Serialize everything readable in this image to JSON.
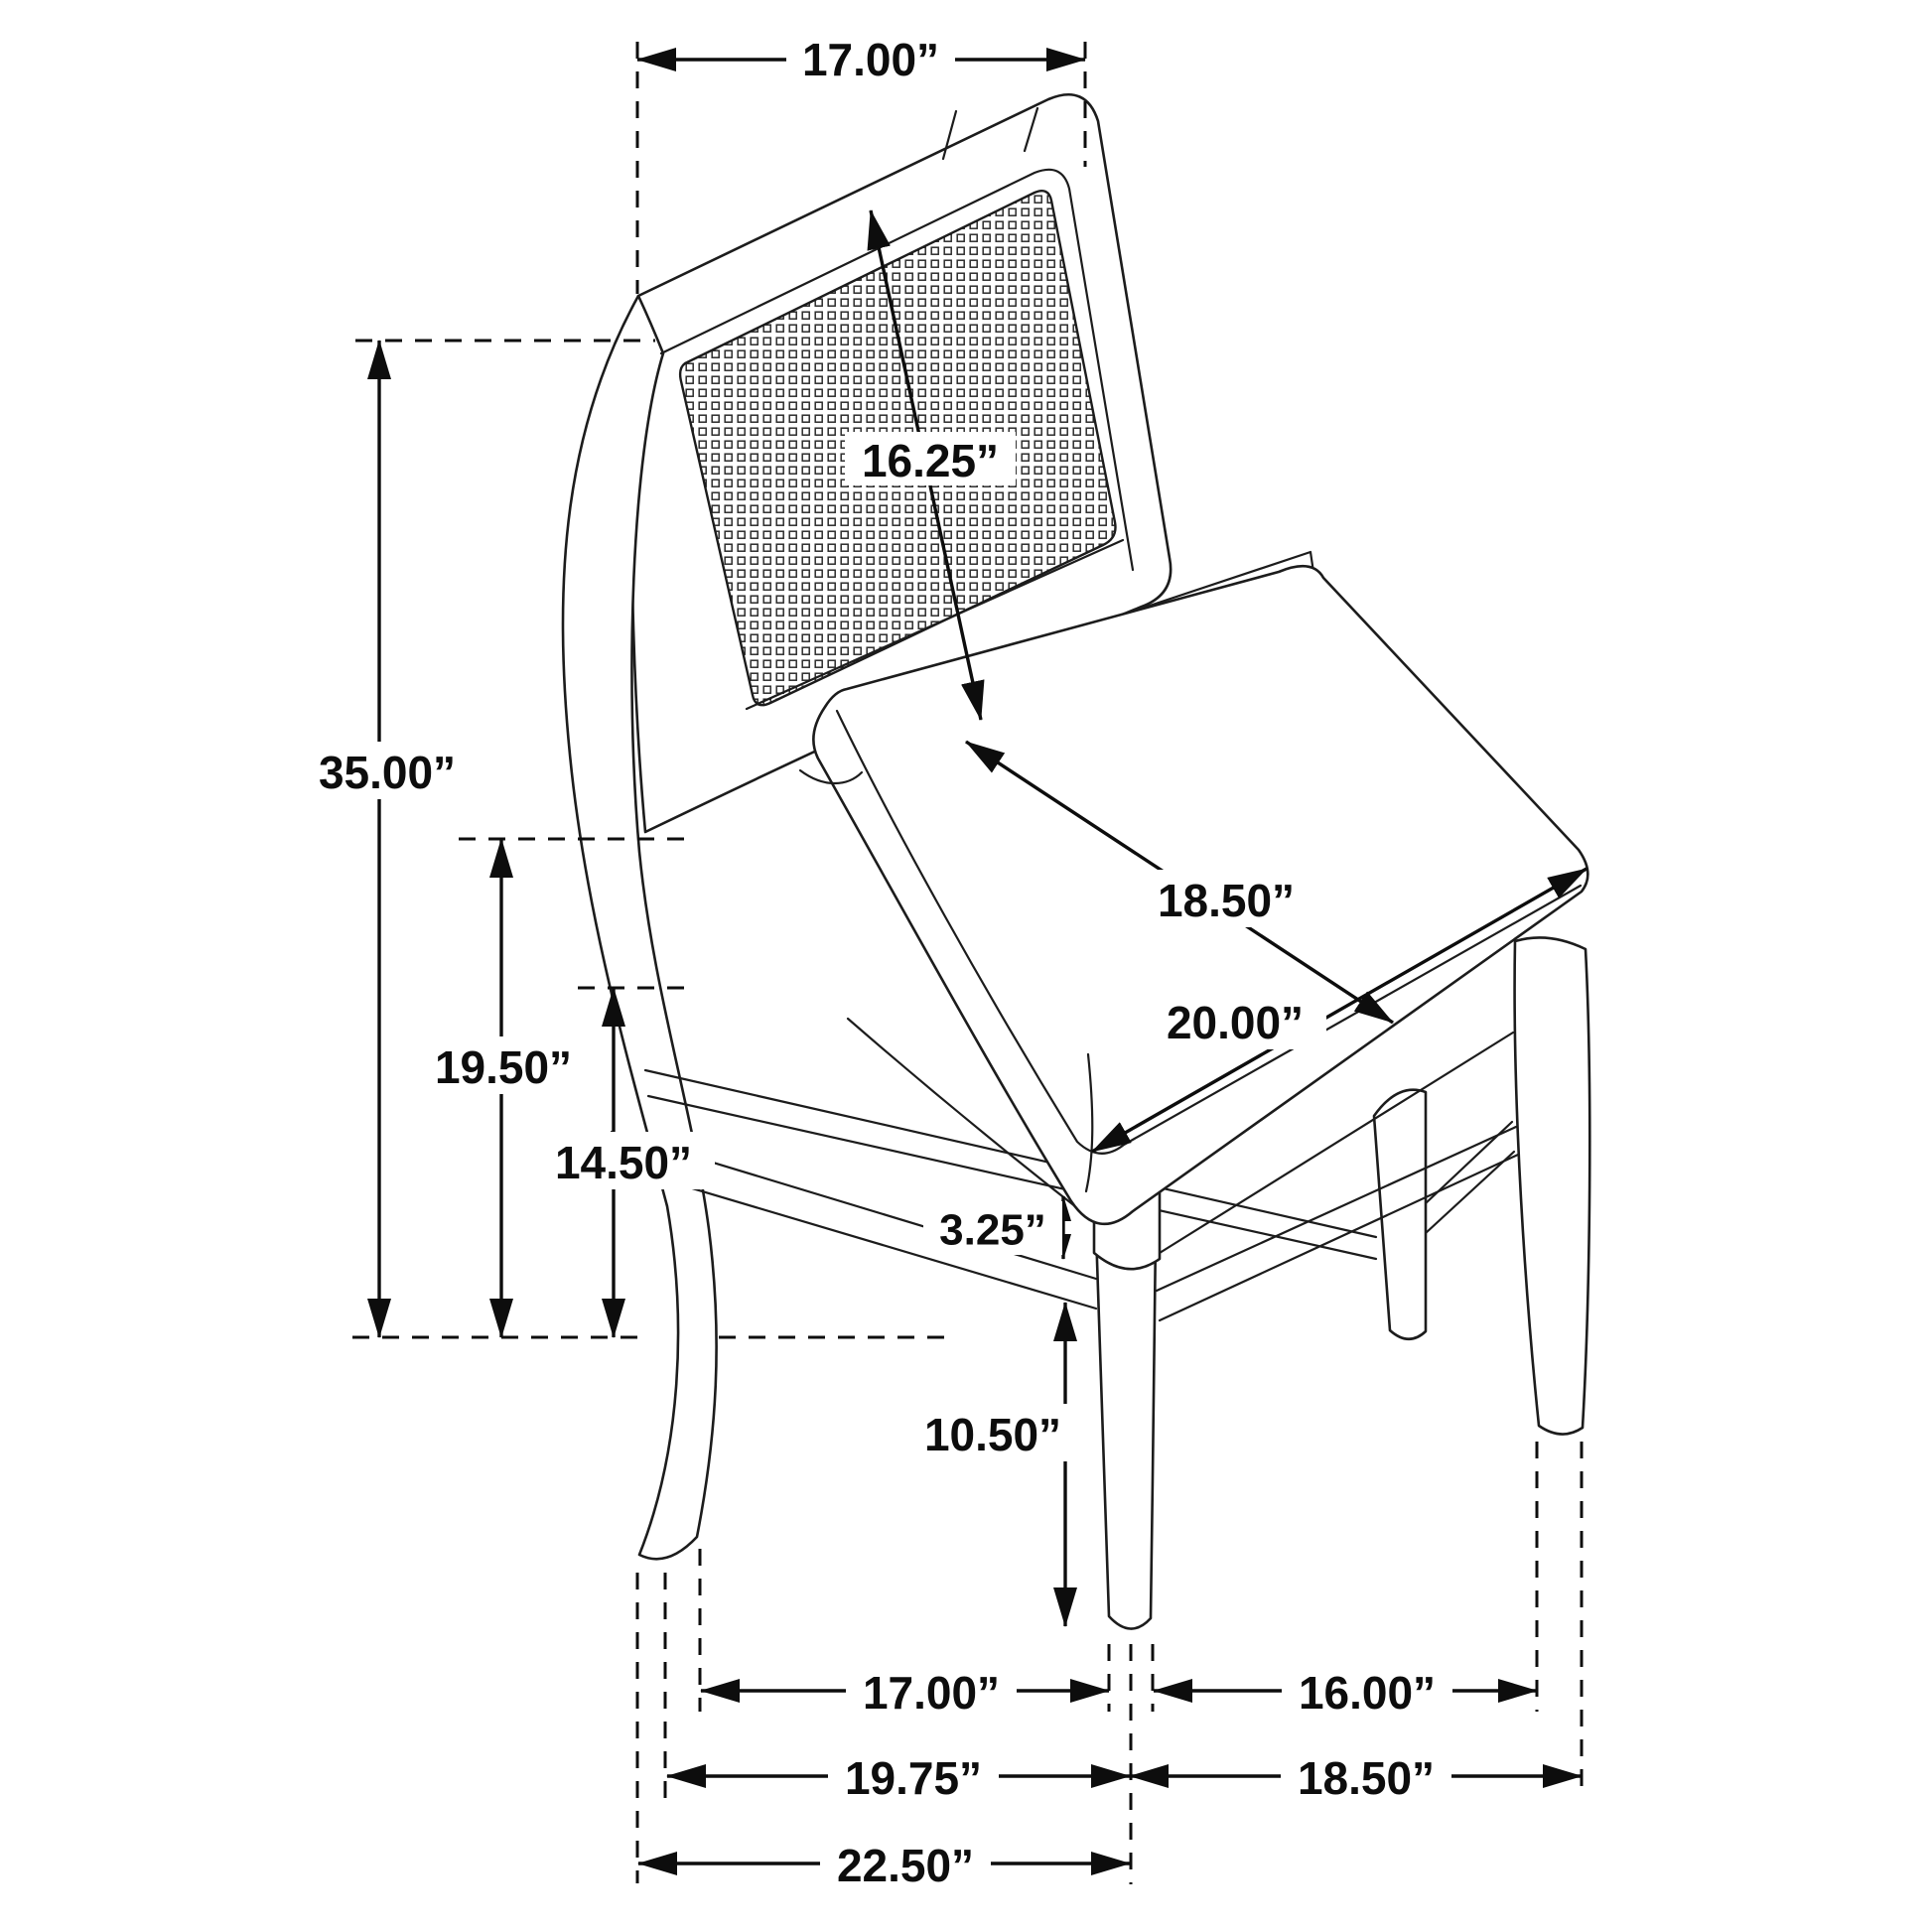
{
  "diagram": {
    "type": "product-dimension-drawing",
    "subject": "Cane-back dining side chair with upholstered seat, isometric line drawing with dimension callouts",
    "unit": "inches",
    "dims": [
      {
        "name": "back-top-width",
        "label": "17.00”"
      },
      {
        "name": "back-panel-height",
        "label": "16.25”"
      },
      {
        "name": "overall-height",
        "label": "35.00”"
      },
      {
        "name": "floor-to-seat-top",
        "label": "19.50”"
      },
      {
        "name": "floor-to-apron",
        "label": "14.50”"
      },
      {
        "name": "seat-depth",
        "label": "18.50”"
      },
      {
        "name": "seat-width",
        "label": "20.00”"
      },
      {
        "name": "apron-height",
        "label": "3.25”"
      },
      {
        "name": "front-leg-height",
        "label": "10.50”"
      },
      {
        "name": "front-legs-inner-span",
        "label": "17.00”"
      },
      {
        "name": "side-legs-inner-span",
        "label": "16.00”"
      },
      {
        "name": "front-width-at-floor",
        "label": "19.75”"
      },
      {
        "name": "side-depth-at-floor",
        "label": "18.50”"
      },
      {
        "name": "overall-depth",
        "label": "22.50”"
      }
    ]
  }
}
